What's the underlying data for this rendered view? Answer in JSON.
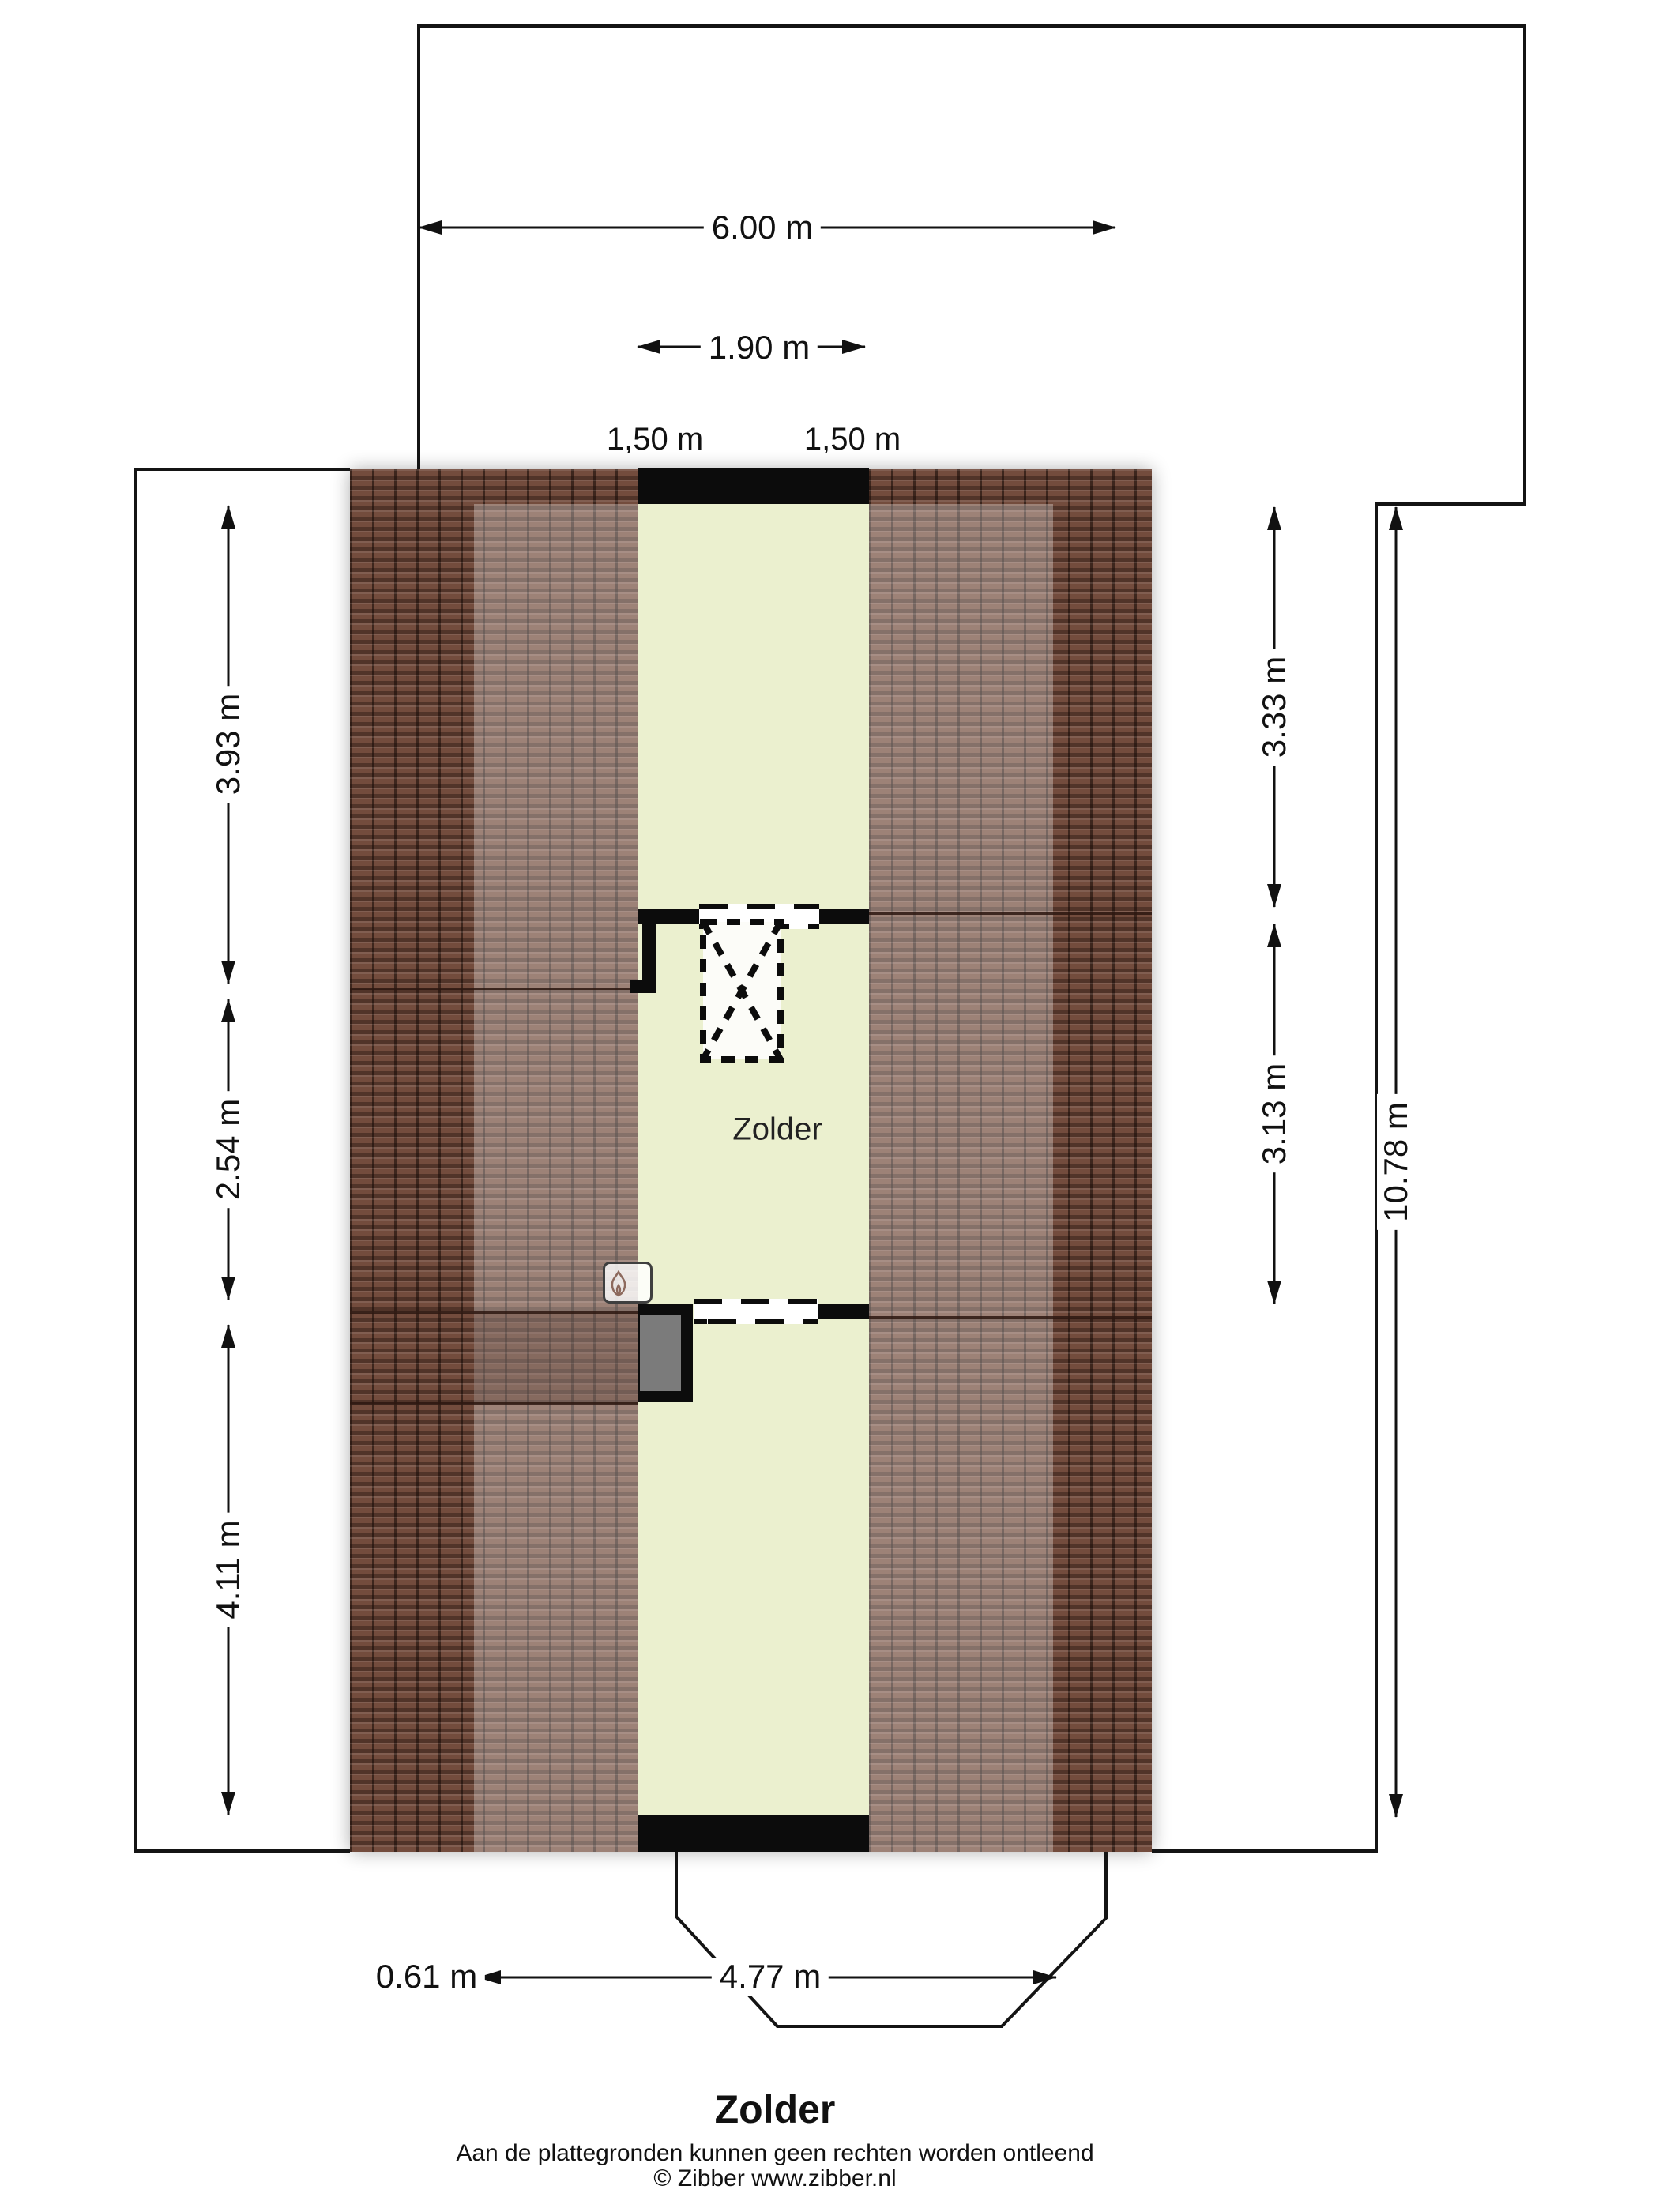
{
  "plan": {
    "room_label": "Zolder",
    "title": "Zolder",
    "disclaimer": "Aan de plattegronden kunnen geen rechten worden ontleend",
    "copyright": "© Zibber www.zibber.nl"
  },
  "dimensions": {
    "top_total_width": "6.00 m",
    "dormer_width": "1.90 m",
    "headroom_left": "1,50 m",
    "headroom_right": "1,50 m",
    "left_top": "3.93 m",
    "left_middle": "2.54 m",
    "left_bottom": "4.11 m",
    "right_top": "3.33 m",
    "right_middle": "3.13 m",
    "right_total": "10.78 m",
    "bottom_offset": "0.61 m",
    "bottom_bay_width": "4.77 m"
  },
  "colors": {
    "roof_base": "#734c3d",
    "roof_line": "#2c1d18",
    "room_fill": "#ebf0cf",
    "wall": "#0c0c0c",
    "chimney_gray": "#7b7b7b",
    "line": "#141414",
    "text": "#111111"
  }
}
